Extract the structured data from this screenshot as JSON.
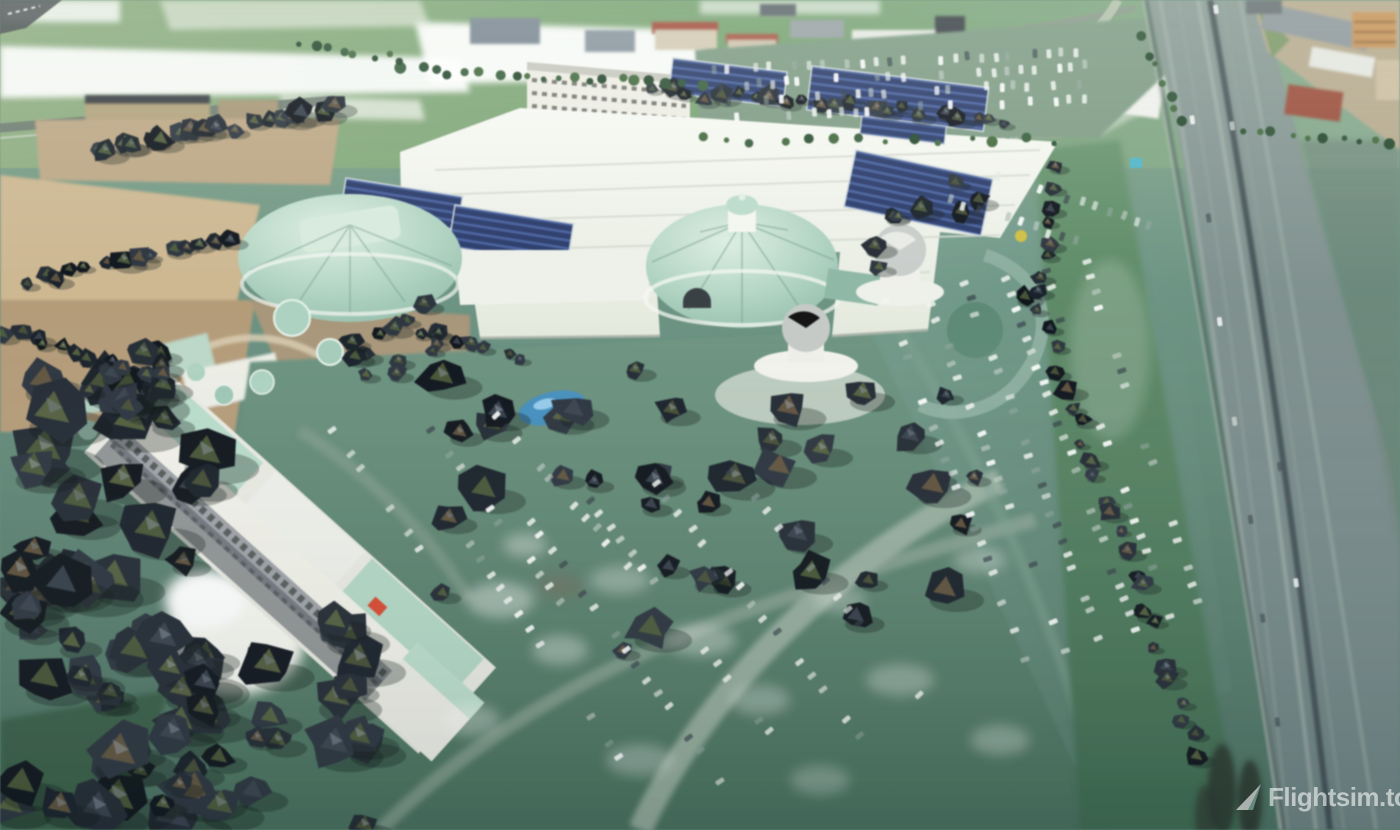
{
  "watermark": {
    "label": "Flightsim.to",
    "icon": "paper-plane",
    "color": "#ffffff",
    "opacity": 0.58
  },
  "scene": {
    "type": "aerial-3d-photogrammetry",
    "palette": {
      "grass_top": "#7aa06d",
      "roof_white": "#f2f4ee",
      "dome_mint": "#aed2c2",
      "solar_blue": "#2b3c6b",
      "parking_teal": "#6a9183",
      "highway_grey": "#7b8d8c",
      "tree_dark": "#161c23",
      "terrace_tan": "#c0ab87",
      "pond_blue": "#3f8fc9"
    },
    "generated": {
      "seed": 13,
      "palettes": {
        "tree_dark": [
          "#10161d",
          "#1a222b",
          "#242c35",
          "#2d3640"
        ],
        "tree_facet": [
          "#3d4652",
          "#4d5638",
          "#5d6a42",
          "#6b5b41",
          "#51603c"
        ],
        "tree_light": [
          "#8b95a0",
          "#77828c",
          "#9aa4ad"
        ],
        "bush": [
          "#2e5236",
          "#3a5f3e",
          "#27492f",
          "#446a3f"
        ],
        "car": [
          "rgba(255,255,255,0.9)",
          "rgba(255,255,255,0.75)",
          "rgba(225,232,226,0.7)",
          "rgba(198,210,204,0.6)",
          "rgba(52,62,70,0.65)",
          "rgba(150,170,165,0.5)",
          "rgba(240,244,240,0.85)"
        ],
        "car_road": [
          "rgba(255,255,255,0.8)",
          "rgba(215,225,220,0.7)",
          "rgba(70,80,88,0.7)"
        ]
      },
      "tree_clusters": [
        {
          "x": 0,
          "y": 375,
          "w": 215,
          "h": 455,
          "count": 60,
          "min": 16,
          "max": 40
        },
        {
          "x": 150,
          "y": 620,
          "w": 220,
          "h": 210,
          "count": 26,
          "min": 14,
          "max": 34
        },
        {
          "x": 60,
          "y": 340,
          "w": 130,
          "h": 70,
          "count": 10,
          "min": 10,
          "max": 22
        },
        {
          "x": 440,
          "y": 360,
          "w": 540,
          "h": 320,
          "count": 40,
          "min": 11,
          "max": 28
        },
        {
          "x": 860,
          "y": 180,
          "w": 120,
          "h": 90,
          "count": 8,
          "min": 8,
          "max": 16
        },
        {
          "x": 330,
          "y": 330,
          "w": 130,
          "h": 60,
          "count": 8,
          "min": 8,
          "max": 16
        },
        {
          "x": 380,
          "y": 300,
          "w": 80,
          "h": 60,
          "count": 5,
          "min": 8,
          "max": 14
        }
      ],
      "tree_rows": [
        {
          "x1": 95,
          "y1": 150,
          "x2": 335,
          "y2": 108,
          "count": 18,
          "min": 9,
          "max": 18
        },
        {
          "x1": 650,
          "y1": 92,
          "x2": 1010,
          "y2": 118,
          "count": 22,
          "min": 7,
          "max": 14
        },
        {
          "x1": 1030,
          "y1": 295,
          "x2": 1200,
          "y2": 755,
          "count": 26,
          "min": 7,
          "max": 15
        },
        {
          "x1": 1055,
          "y1": 170,
          "x2": 1035,
          "y2": 290,
          "count": 8,
          "min": 6,
          "max": 12
        },
        {
          "x1": 420,
          "y1": 333,
          "x2": 520,
          "y2": 360,
          "count": 7,
          "min": 7,
          "max": 13
        },
        {
          "x1": 25,
          "y1": 282,
          "x2": 235,
          "y2": 242,
          "count": 14,
          "min": 8,
          "max": 16
        },
        {
          "x1": 5,
          "y1": 330,
          "x2": 120,
          "y2": 370,
          "count": 9,
          "min": 8,
          "max": 15
        }
      ],
      "bush_rows": [
        {
          "x1": 405,
          "y1": 70,
          "x2": 700,
          "y2": 86,
          "count": 20
        },
        {
          "x1": 300,
          "y1": 45,
          "x2": 400,
          "y2": 60,
          "count": 8
        },
        {
          "x1": 1145,
          "y1": 40,
          "x2": 1185,
          "y2": 120,
          "count": 7
        },
        {
          "x1": 1240,
          "y1": 130,
          "x2": 1390,
          "y2": 140,
          "count": 10
        },
        {
          "x1": 700,
          "y1": 140,
          "x2": 1050,
          "y2": 140,
          "count": 14
        }
      ],
      "car_rows": [
        {
          "x1": 885,
          "y1": 300,
          "x2": 1025,
          "y2": 660,
          "gap": 15
        },
        {
          "x1": 925,
          "y1": 290,
          "x2": 1065,
          "y2": 650,
          "gap": 15
        },
        {
          "x1": 965,
          "y1": 285,
          "x2": 1100,
          "y2": 640,
          "gap": 15
        },
        {
          "x1": 1005,
          "y1": 280,
          "x2": 1135,
          "y2": 628,
          "gap": 15
        },
        {
          "x1": 1045,
          "y1": 272,
          "x2": 1168,
          "y2": 615,
          "gap": 16
        },
        {
          "x1": 1085,
          "y1": 262,
          "x2": 1198,
          "y2": 600,
          "gap": 16
        },
        {
          "x1": 950,
          "y1": 200,
          "x2": 1120,
          "y2": 255,
          "gap": 14
        },
        {
          "x1": 1000,
          "y1": 175,
          "x2": 1150,
          "y2": 225,
          "gap": 14
        },
        {
          "x1": 715,
          "y1": 70,
          "x2": 1075,
          "y2": 52,
          "gap": 13
        },
        {
          "x1": 720,
          "y1": 86,
          "x2": 1085,
          "y2": 66,
          "gap": 13
        },
        {
          "x1": 728,
          "y1": 102,
          "x2": 1092,
          "y2": 82,
          "gap": 13
        },
        {
          "x1": 735,
          "y1": 118,
          "x2": 1096,
          "y2": 98,
          "gap": 13
        },
        {
          "x1": 470,
          "y1": 545,
          "x2": 650,
          "y2": 800,
          "gap": 17
        },
        {
          "x1": 530,
          "y1": 520,
          "x2": 720,
          "y2": 780,
          "gap": 17
        },
        {
          "x1": 590,
          "y1": 500,
          "x2": 790,
          "y2": 760,
          "gap": 17
        },
        {
          "x1": 655,
          "y1": 485,
          "x2": 860,
          "y2": 735,
          "gap": 18
        },
        {
          "x1": 730,
          "y1": 470,
          "x2": 930,
          "y2": 710,
          "gap": 18
        },
        {
          "x1": 430,
          "y1": 430,
          "x2": 560,
          "y2": 600,
          "gap": 16
        },
        {
          "x1": 495,
          "y1": 415,
          "x2": 640,
          "y2": 580,
          "gap": 16
        },
        {
          "x1": 330,
          "y1": 430,
          "x2": 430,
          "y2": 560,
          "gap": 15
        },
        {
          "x1": 1180,
          "y1": 20,
          "x2": 1290,
          "y2": 820,
          "gap": 95,
          "along": true
        },
        {
          "x1": 1215,
          "y1": 10,
          "x2": 1330,
          "y2": 810,
          "gap": 110,
          "along": true
        }
      ]
    }
  }
}
